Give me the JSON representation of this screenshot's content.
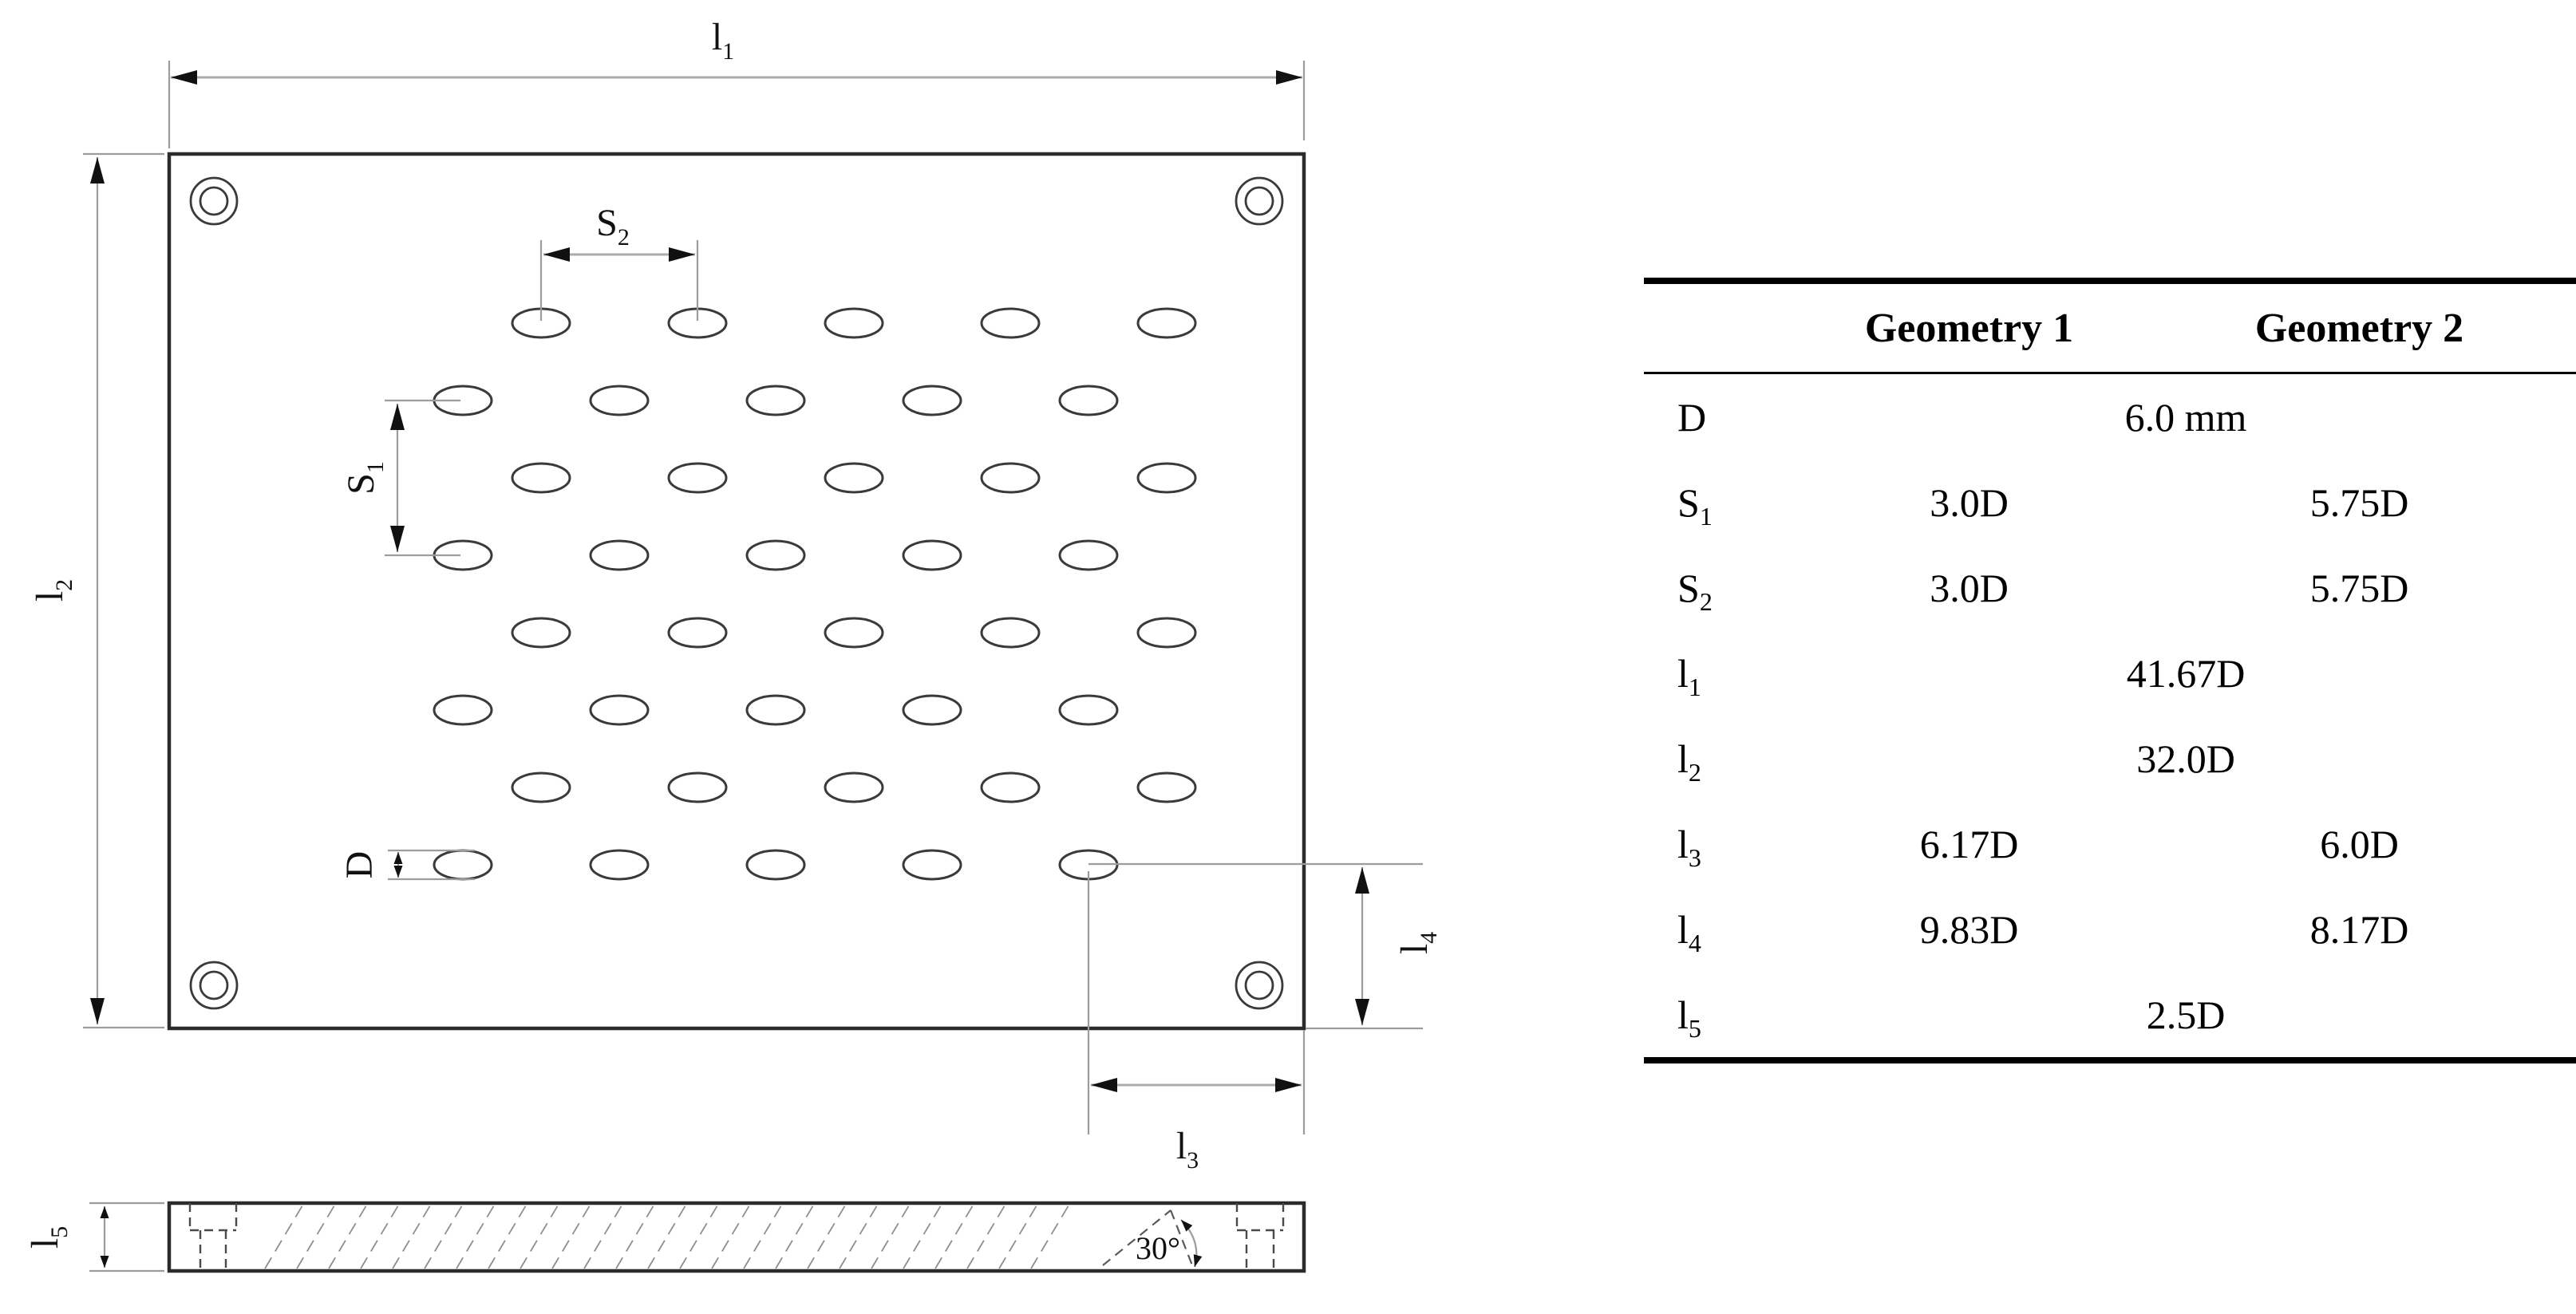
{
  "drawing": {
    "labels": {
      "l1": {
        "base": "l",
        "sub": "1"
      },
      "l2": {
        "base": "l",
        "sub": "2"
      },
      "l3": {
        "base": "l",
        "sub": "3"
      },
      "l4": {
        "base": "l",
        "sub": "4"
      },
      "l5": {
        "base": "l",
        "sub": "5"
      },
      "S1": {
        "base": "S",
        "sub": "1"
      },
      "S2": {
        "base": "S",
        "sub": "2"
      },
      "D": {
        "base": "D",
        "sub": ""
      }
    },
    "angle_label": "30°"
  },
  "table": {
    "headers": [
      "Geometry 1",
      "Geometry 2"
    ],
    "rows": [
      {
        "label": {
          "base": "D",
          "sub": ""
        },
        "span": "6.0 mm",
        "g1": "",
        "g2": ""
      },
      {
        "label": {
          "base": "S",
          "sub": "1"
        },
        "span": "",
        "g1": "3.0D",
        "g2": "5.75D"
      },
      {
        "label": {
          "base": "S",
          "sub": "2"
        },
        "span": "",
        "g1": "3.0D",
        "g2": "5.75D"
      },
      {
        "label": {
          "base": "l",
          "sub": "1"
        },
        "span": "41.67D",
        "g1": "",
        "g2": ""
      },
      {
        "label": {
          "base": "l",
          "sub": "2"
        },
        "span": "32.0D",
        "g1": "",
        "g2": ""
      },
      {
        "label": {
          "base": "l",
          "sub": "3"
        },
        "span": "",
        "g1": "6.17D",
        "g2": "6.0D"
      },
      {
        "label": {
          "base": "l",
          "sub": "4"
        },
        "span": "",
        "g1": "9.83D",
        "g2": "8.17D"
      },
      {
        "label": {
          "base": "l",
          "sub": "5"
        },
        "span": "2.5D",
        "g1": "",
        "g2": ""
      }
    ]
  }
}
